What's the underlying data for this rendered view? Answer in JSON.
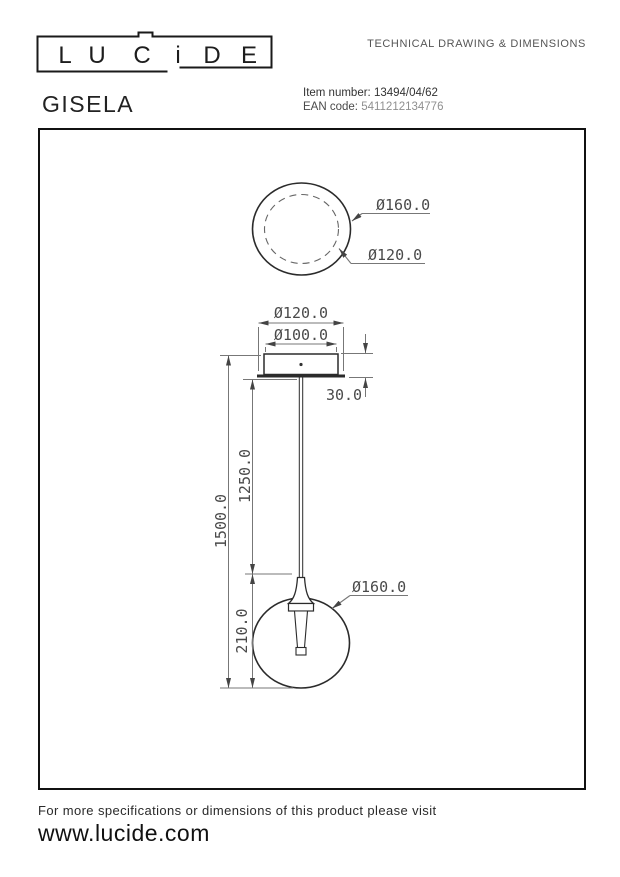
{
  "header": {
    "logo": {
      "letters": [
        "L",
        "U",
        "C",
        "i",
        "D",
        "E"
      ]
    },
    "doc_type": "TECHNICAL DRAWING & DIMENSIONS",
    "product_name": "GISELA",
    "item_number_label": "Item number:",
    "item_number_value": "13494/04/62",
    "ean_label": "EAN code:",
    "ean_value": "5411212134776"
  },
  "drawing": {
    "top_view": {
      "outer_diameter": "Ø160.0",
      "inner_diameter": "Ø120.0"
    },
    "front_view": {
      "canopy_diameter": "Ø120.0",
      "canopy_inner_diameter": "Ø100.0",
      "canopy_height": "30.0",
      "total_height": "1500.0",
      "cord_length": "1250.0",
      "shade_height": "210.0",
      "shade_diameter": "Ø160.0"
    }
  },
  "footer": {
    "note": "For more specifications or dimensions of this product please visit",
    "website": "www.lucide.com"
  }
}
